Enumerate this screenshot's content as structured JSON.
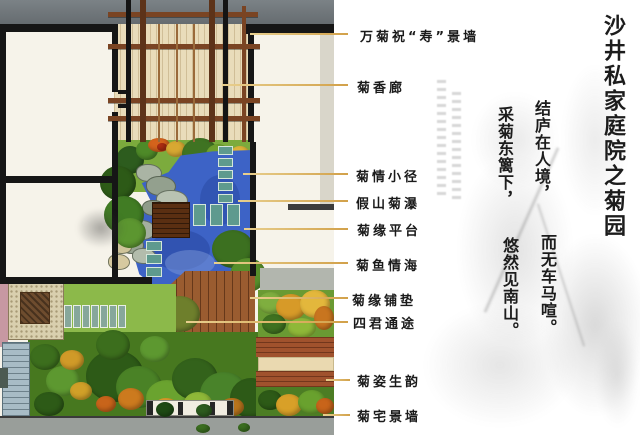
{
  "title": "沙井私家庭院之菊园",
  "poem": {
    "columns": [
      "结庐在人境，",
      "而无车马喧。",
      "采菊东篱下，",
      "悠然见南山。"
    ]
  },
  "callouts": [
    {
      "label": "万菊祝“寿”景墙"
    },
    {
      "label": "菊香廊"
    },
    {
      "label": "菊情小径"
    },
    {
      "label": "假山菊瀑"
    },
    {
      "label": "菊缘平台"
    },
    {
      "label": "菊鱼情海"
    },
    {
      "label": "菊缘铺垫"
    },
    {
      "label": "四君通途"
    },
    {
      "label": "菊姿生韵"
    },
    {
      "label": "菊宅景墙"
    }
  ],
  "colors": {
    "leader_line": "#D2A14A",
    "pond_water": "#3D63C6",
    "deck_wood": "#9A5C30",
    "pergola_wood": "#7A4423",
    "top_wall_gray": "#6F767A",
    "label_text": "#1A1A1A"
  }
}
